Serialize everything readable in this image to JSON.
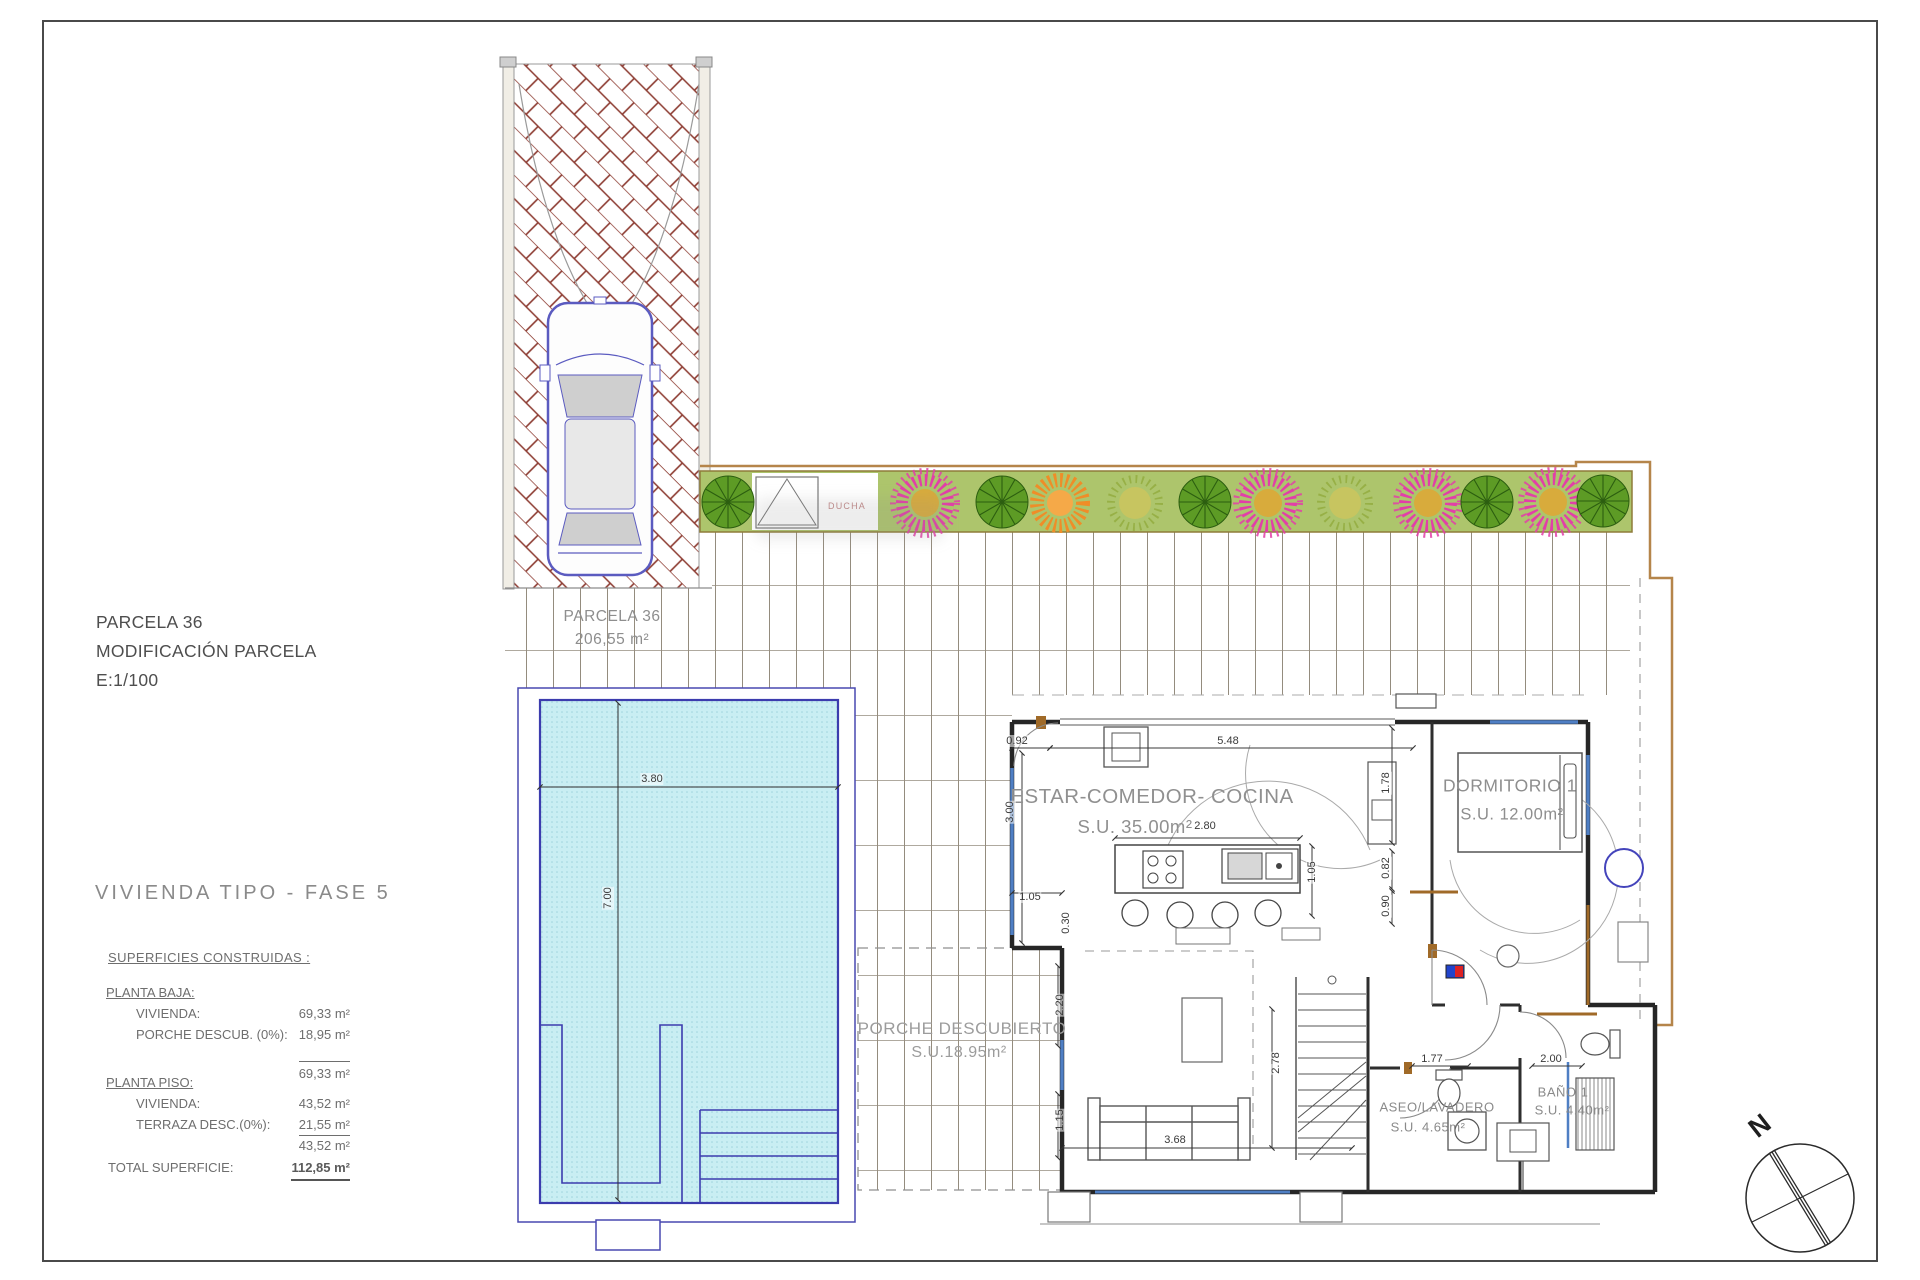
{
  "drawing": {
    "info_block": {
      "parcel": "PARCELA 36",
      "modification": "MODIFICACIÓN PARCELA",
      "scale": "E:1/100"
    },
    "title": "VIVIENDA TIPO - FASE 5",
    "areas_table": {
      "heading": "SUPERFICIES CONSTRUIDAS :",
      "planta_baja_label": "PLANTA BAJA:",
      "pb_vivienda_label": "VIVIENDA:",
      "pb_vivienda_value": "69,33 m²",
      "pb_porche_label": "PORCHE DESCUB. (0%):",
      "pb_porche_value": "18,95 m²",
      "pb_subtotal": "69,33 m²",
      "planta_piso_label": "PLANTA PISO:",
      "pp_vivienda_label": "VIVIENDA:",
      "pp_vivienda_value": "43,52 m²",
      "pp_terraza_label": "TERRAZA DESC.(0%):",
      "pp_terraza_value": "21,55 m²",
      "pp_subtotal": "43,52 m²",
      "total_label": "TOTAL SUPERFICIE:",
      "total_value": "112,85 m²"
    },
    "plan": {
      "parcel_name": "PARCELA 36",
      "parcel_area": "206,55 m²",
      "rooms": [
        {
          "name": "ESTAR-COMEDOR- COCINA",
          "area": "S.U. 35.00m²"
        },
        {
          "name": "DORMITORIO 1",
          "area": "S.U. 12.00m²"
        },
        {
          "name": "PORCHE DESCUBIERTO",
          "area": "S.U.18.95m²"
        },
        {
          "name": "ASEO/LAVADERO",
          "area": "S.U. 4.65m²"
        },
        {
          "name": "BAÑO 1",
          "area": "S.U. 4.40m²"
        }
      ],
      "ducha": "DUCHA",
      "north": "N",
      "dimensions": [
        {
          "text": "0.92",
          "x": 1017,
          "y": 741,
          "rot": 0
        },
        {
          "text": "5.48",
          "x": 1228,
          "y": 741,
          "rot": 0
        },
        {
          "text": "3.00",
          "x": 1010,
          "y": 812,
          "rot": -90
        },
        {
          "text": "1.78",
          "x": 1386,
          "y": 783,
          "rot": -90
        },
        {
          "text": "2.80",
          "x": 1205,
          "y": 826,
          "rot": 0
        },
        {
          "text": "1.05",
          "x": 1312,
          "y": 872,
          "rot": -90
        },
        {
          "text": "0.82",
          "x": 1386,
          "y": 868,
          "rot": -90
        },
        {
          "text": "0.90",
          "x": 1386,
          "y": 906,
          "rot": -90
        },
        {
          "text": "1.05",
          "x": 1030,
          "y": 897,
          "rot": 0
        },
        {
          "text": "0.30",
          "x": 1066,
          "y": 923,
          "rot": -90
        },
        {
          "text": "2.20",
          "x": 1060,
          "y": 1005,
          "rot": -90
        },
        {
          "text": "1.15",
          "x": 1060,
          "y": 1120,
          "rot": -90
        },
        {
          "text": "3.68",
          "x": 1175,
          "y": 1140,
          "rot": 0
        },
        {
          "text": "2.78",
          "x": 1276,
          "y": 1063,
          "rot": -90
        },
        {
          "text": "1.77",
          "x": 1432,
          "y": 1059,
          "rot": 0
        },
        {
          "text": "2.00",
          "x": 1551,
          "y": 1059,
          "rot": 0
        },
        {
          "text": "3.80",
          "x": 652,
          "y": 779,
          "rot": 0
        },
        {
          "text": "7.00",
          "x": 608,
          "y": 898,
          "rot": -90
        }
      ]
    }
  }
}
